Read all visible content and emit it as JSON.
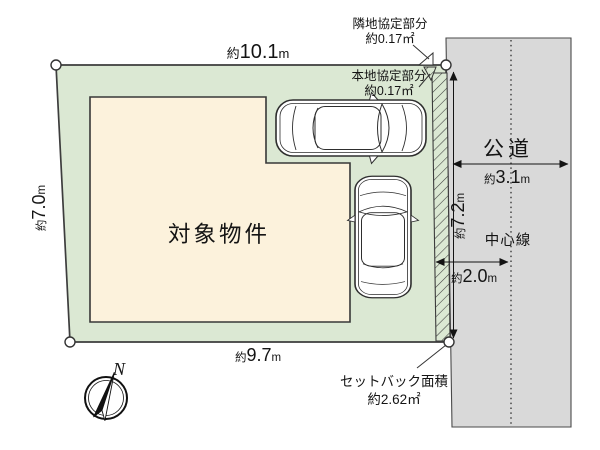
{
  "colors": {
    "plot_green": "#dbe8d3",
    "building_beige": "#fcf2dc",
    "road_gray": "#d9d9d9",
    "line_dark": "#3d3d3d"
  },
  "plot": {
    "label": "対象物件"
  },
  "road": {
    "name": "公道",
    "center_line_label": "中心線"
  },
  "compass": {
    "north_label": "N"
  },
  "dimensions": {
    "top": {
      "p": "約",
      "v": "10.1",
      "u": "m"
    },
    "left": {
      "p": "約",
      "v": "7.0",
      "u": "m"
    },
    "bottom": {
      "p": "約",
      "v": "9.7",
      "u": "m"
    },
    "road_width": {
      "p": "約",
      "v": "3.1",
      "u": "m"
    },
    "road_frontage": {
      "p": "約",
      "v": "7.2",
      "u": "m"
    },
    "edge_to_center": {
      "p": "約",
      "v": "2.0",
      "u": "m"
    }
  },
  "annotations": {
    "neighbor_agreement": {
      "title": "隣地協定部分",
      "area": "約0.17㎡"
    },
    "subject_agreement": {
      "title": "本地協定部分",
      "area": "約0.17㎡"
    },
    "setback": {
      "title": "セットバック面積",
      "area": "約2.62㎡"
    }
  }
}
